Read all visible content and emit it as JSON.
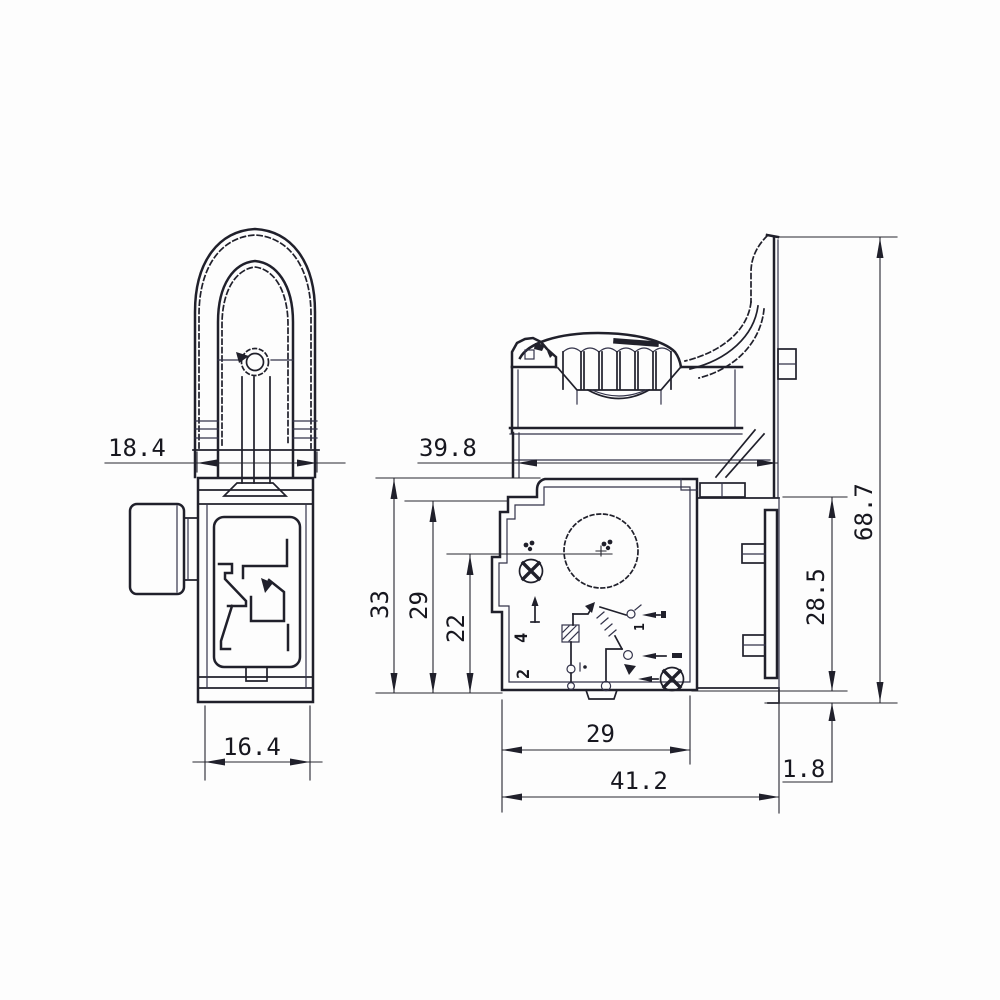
{
  "drawing": {
    "kind": "trigger-switch-technical-drawing",
    "background": "#fdfdfd",
    "ink_color": "#20202b",
    "views": {
      "side_view": {
        "dimensions": {
          "top_width": "18.4",
          "bottom_width": "16.4"
        }
      },
      "front_view": {
        "dimensions": {
          "trigger_depth": "39.8",
          "body_height": "33",
          "step_height": "29",
          "center_height": "22",
          "body_width": "29",
          "overall_width": "41.2",
          "base_offset": "1.8",
          "terminal_height": "28.5",
          "overall_height": "68.7"
        },
        "schematic_marks": {
          "terminal_4": "4",
          "terminal_2": "2",
          "terminal_1": "1"
        }
      }
    }
  }
}
